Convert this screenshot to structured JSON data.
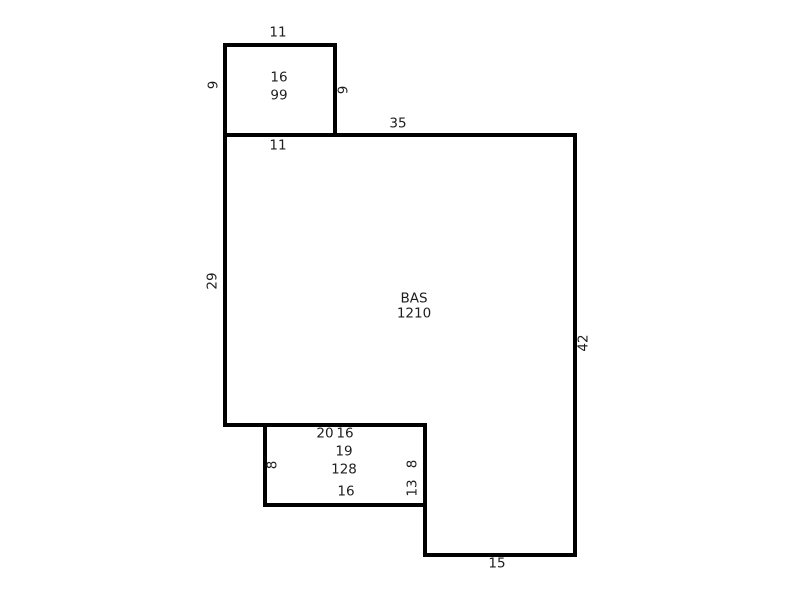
{
  "sketch": {
    "top_addition": {
      "code": "16",
      "area": "99",
      "dim_top": "11",
      "dim_left": "9",
      "dim_right": "9",
      "dim_bottom": "11"
    },
    "main_area": {
      "code": "BAS",
      "area": "1210",
      "dim_top": "35",
      "dim_left": "29",
      "dim_right": "42",
      "dim_bottom": "20",
      "dim_step_right": "13",
      "dim_bottom_right": "15"
    },
    "bottom_addition": {
      "code": "19",
      "area": "128",
      "dim_top": "16",
      "dim_left": "8",
      "dim_right": "8",
      "dim_bottom": "16"
    },
    "colors": {
      "wall": "#000000",
      "text": "#1e1e1e",
      "background": "#ffffff"
    }
  }
}
